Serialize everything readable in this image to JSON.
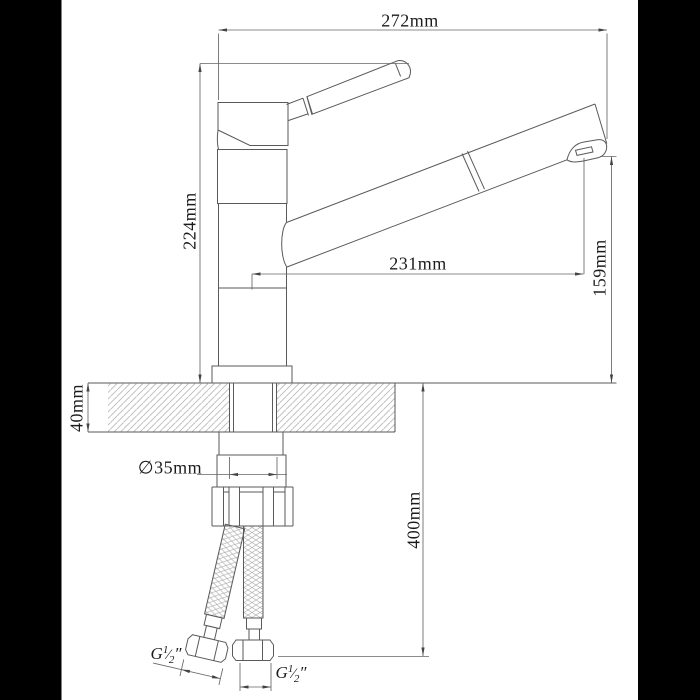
{
  "drawing": {
    "type": "technical-drawing",
    "subject": "single-lever kitchen mixer tap, side elevation with installation dimensions",
    "dimensions": {
      "overall_width": "272mm",
      "height_above_counter": "224mm",
      "spout_reach": "231mm",
      "spout_outlet_height": "159mm",
      "counter_thickness": "40mm",
      "mounting_hole": "∅35mm",
      "hose_length": "400mm"
    },
    "thread_labels": {
      "left": {
        "prefix": "G",
        "numerator": "1",
        "slash": "⁄",
        "denominator": "2",
        "suffix": "″"
      },
      "right": {
        "prefix": "G",
        "numerator": "1",
        "slash": "⁄",
        "denominator": "2",
        "suffix": "″"
      }
    },
    "colors": {
      "background": "#ffffff",
      "letterbox": "#000000",
      "line": "#5a5a5a",
      "dimension_line": "#666666",
      "hatch": "#b9b9b9",
      "text": "#1b1b1b"
    }
  }
}
